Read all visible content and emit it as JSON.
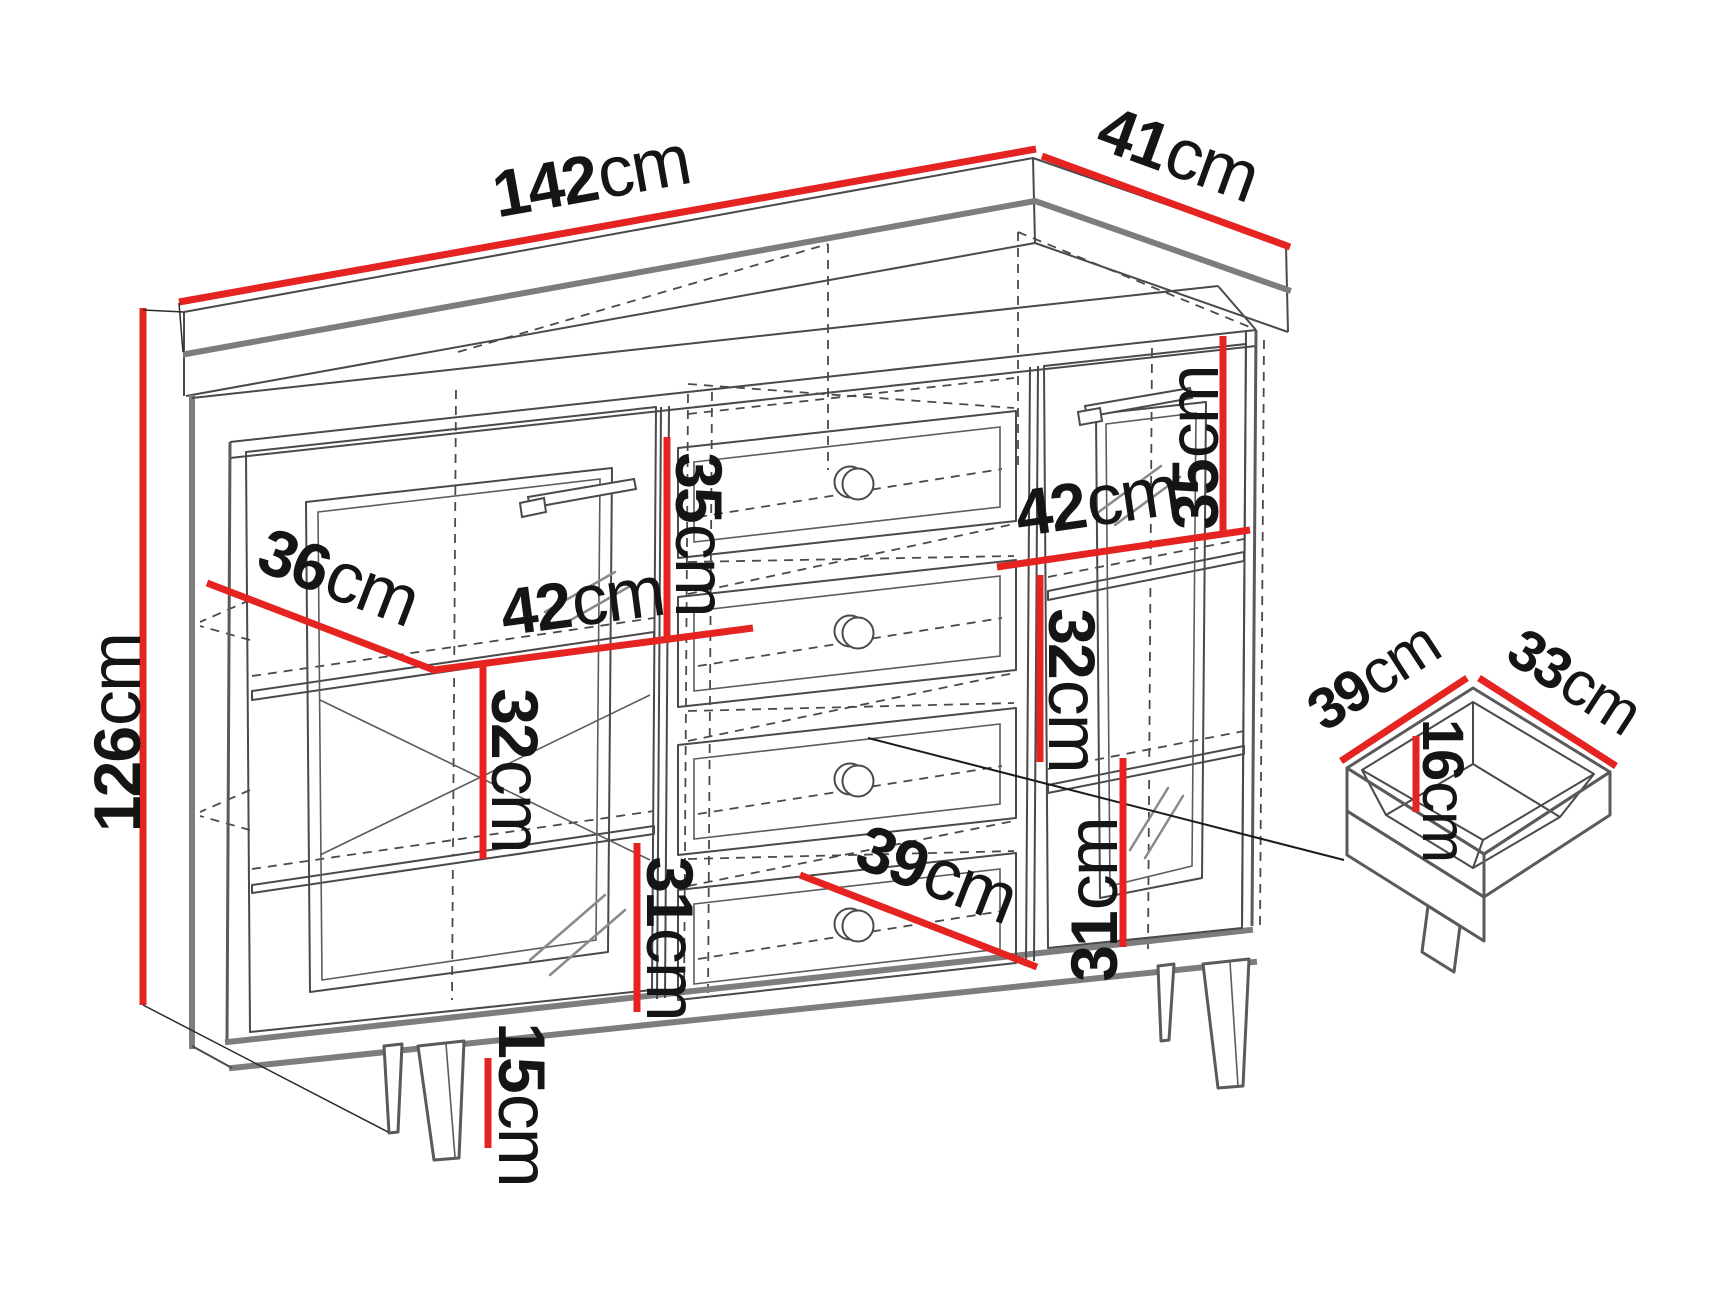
{
  "diagram": {
    "kind": "furniture-dimension-line-drawing",
    "subject": "sideboard with two doors, four center drawers, tapered legs, and a detached drawer box detail",
    "background_color": "#ffffff"
  },
  "colors": {
    "dimension_line": "#e52421",
    "outline_thick": "#7d7d7d",
    "outline_thin": "#4a4a4a",
    "label_text": "#151515"
  },
  "dimensions": {
    "overall_width": {
      "value": "142",
      "unit": "cm"
    },
    "overall_depth": {
      "value": "41",
      "unit": "cm"
    },
    "overall_height": {
      "value": "126",
      "unit": "cm"
    },
    "interior_depth": {
      "value": "36",
      "unit": "cm"
    },
    "left_top_section_height": {
      "value": "35",
      "unit": "cm"
    },
    "left_compartment_width": {
      "value": "42",
      "unit": "cm"
    },
    "left_middle_section_height": {
      "value": "32",
      "unit": "cm"
    },
    "left_bottom_section_height": {
      "value": "31",
      "unit": "cm"
    },
    "leg_height": {
      "value": "15",
      "unit": "cm"
    },
    "drawer_opening_width": {
      "value": "39",
      "unit": "cm"
    },
    "right_top_section_height": {
      "value": "35",
      "unit": "cm"
    },
    "right_compartment_width": {
      "value": "42",
      "unit": "cm"
    },
    "right_middle_section_height": {
      "value": "32",
      "unit": "cm"
    },
    "right_bottom_section_height": {
      "value": "31",
      "unit": "cm"
    },
    "drawer_box_width": {
      "value": "39",
      "unit": "cm"
    },
    "drawer_box_depth": {
      "value": "33",
      "unit": "cm"
    },
    "drawer_box_height": {
      "value": "16",
      "unit": "cm"
    }
  }
}
